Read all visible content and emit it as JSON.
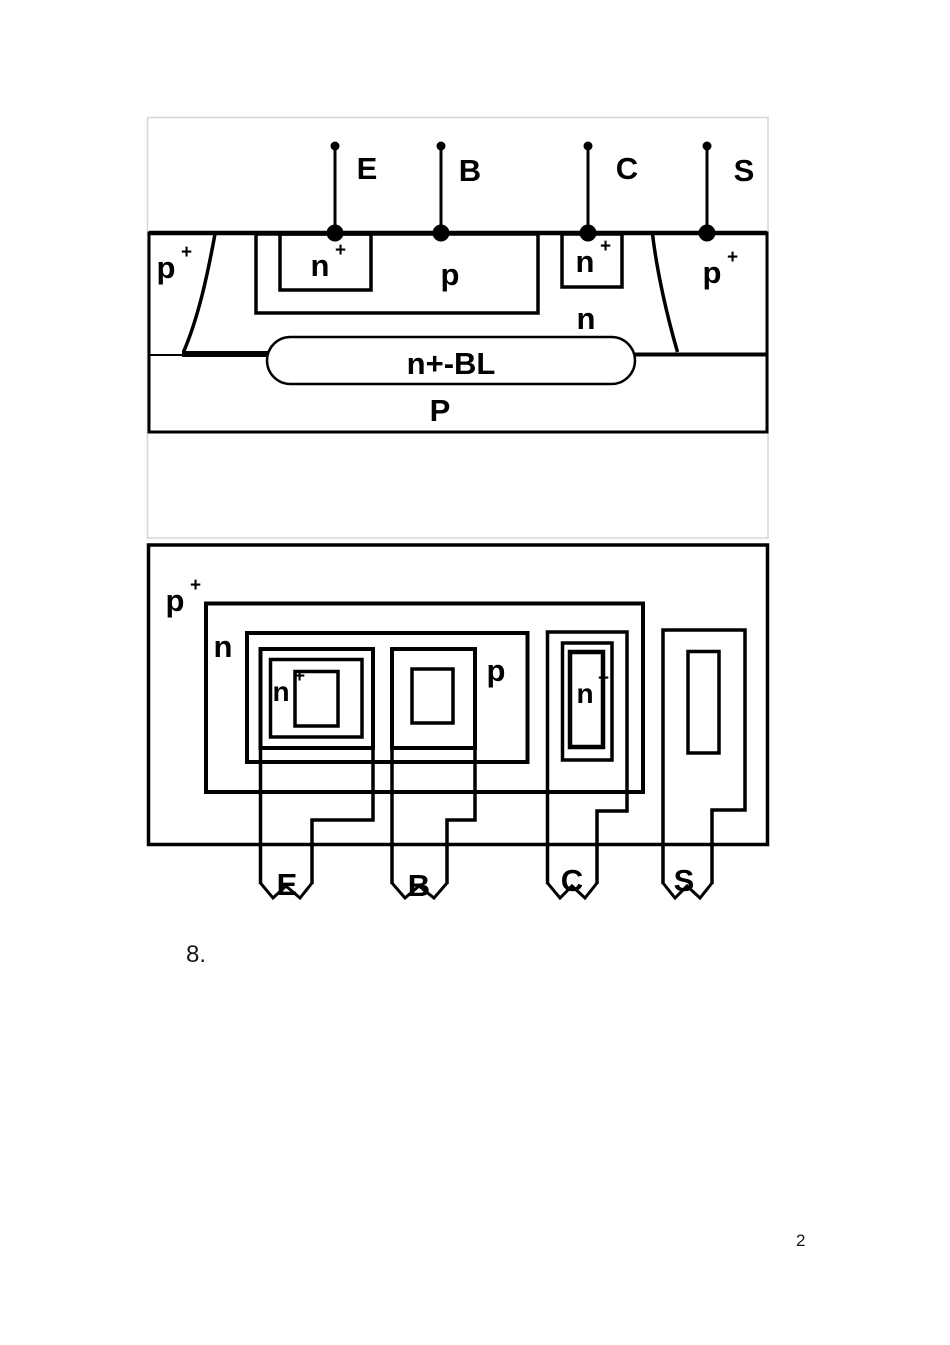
{
  "page": {
    "item_number": "8.",
    "page_number": "2"
  },
  "colors": {
    "line": "#000000",
    "panel_border": "#d6d6d6",
    "background": "#ffffff",
    "text": "#161616"
  },
  "cross_section": {
    "terminals": [
      {
        "label": "E"
      },
      {
        "label": "B"
      },
      {
        "label": "C"
      },
      {
        "label": "S"
      }
    ],
    "regions": {
      "p_plus_left": {
        "base": "p",
        "sup": "+"
      },
      "n_plus_emitter": {
        "base": "n",
        "sup": "+"
      },
      "p_base": {
        "base": "p"
      },
      "n_plus_collector": {
        "base": "n",
        "sup": "+"
      },
      "p_plus_right": {
        "base": "p",
        "sup": "+"
      },
      "n_epi": {
        "base": "n"
      },
      "buried_layer": {
        "base": "n+-BL"
      },
      "substrate": {
        "base": "P"
      }
    }
  },
  "layout_view": {
    "regions": {
      "p_plus_iso": {
        "base": "p",
        "sup": "+"
      },
      "n_well": {
        "base": "n"
      },
      "p_base": {
        "base": "p"
      },
      "n_plus_emitter": {
        "base": "n",
        "sup": "+"
      },
      "n_plus_collector": {
        "base": "n",
        "sup": "+"
      }
    },
    "terminals": [
      {
        "label": "E"
      },
      {
        "label": "B"
      },
      {
        "label": "C"
      },
      {
        "label": "S"
      }
    ]
  }
}
